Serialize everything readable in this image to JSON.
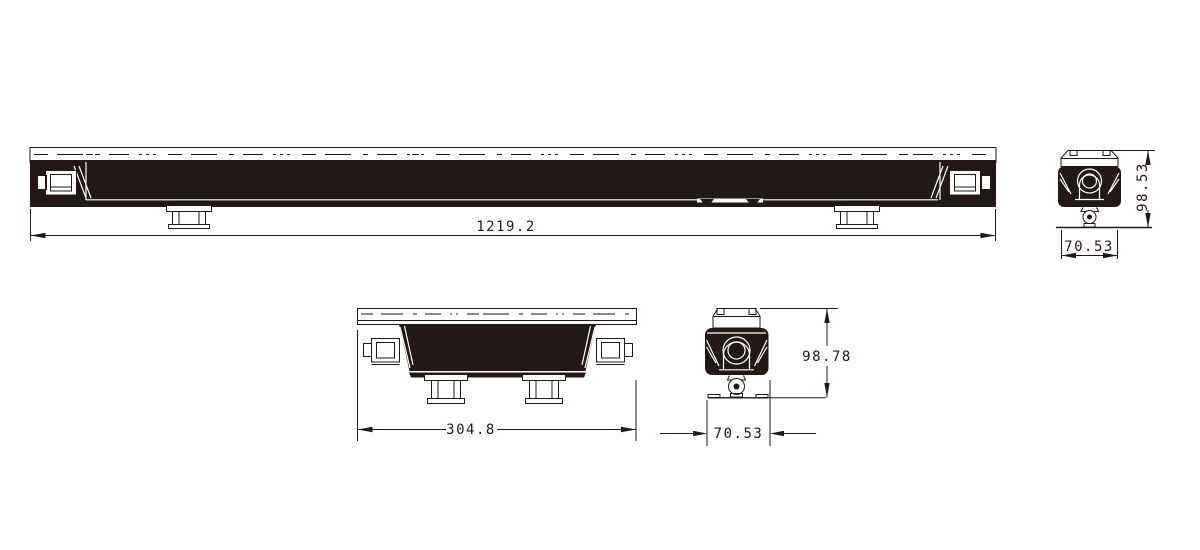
{
  "colors": {
    "ink": "#231815",
    "background": "#ffffff"
  },
  "dimensions": {
    "front_length": "1219.2",
    "front_end_height": "98.53",
    "front_end_width": "70.53",
    "short_length": "304.8",
    "short_end_height": "98.78",
    "short_end_width": "70.53"
  }
}
